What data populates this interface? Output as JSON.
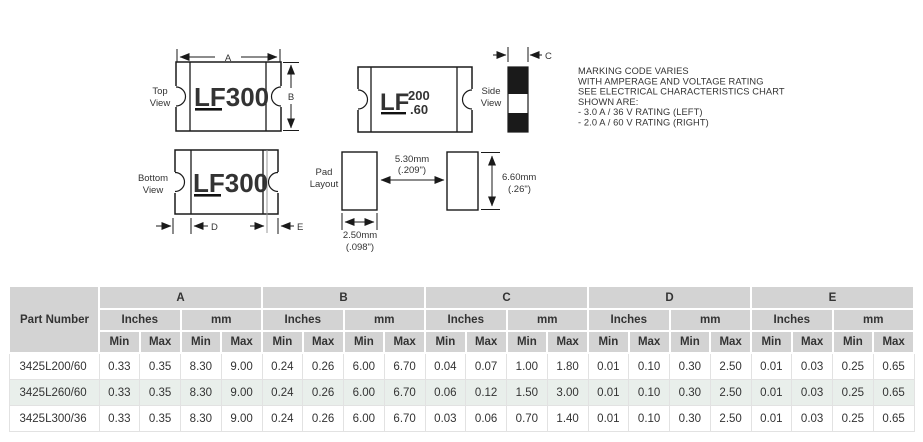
{
  "colors": {
    "table_header_bg": "#d3d3d3",
    "table_row_alt": "#e9efeb",
    "line": "#1a1a1a"
  },
  "diagram": {
    "top_view": {
      "label1": "Top",
      "label2": "View",
      "marking_logo": "LF",
      "marking_text": "300"
    },
    "right_unit": {
      "marking_logo": "LF",
      "marking_top": "200",
      "marking_bottom": ".60"
    },
    "side_view": {
      "label1": "Side",
      "label2": "View"
    },
    "bottom_view": {
      "label1": "Bottom",
      "label2": "View",
      "marking_logo": "LF",
      "marking_text": "300"
    },
    "pad_layout": {
      "label1": "Pad",
      "label2": "Layout",
      "gap_mm": "5.30mm",
      "gap_in": "(.209\")",
      "height_mm": "6.60mm",
      "height_in": "(.26\")",
      "width_mm": "2.50mm",
      "width_in": "(.098\")"
    },
    "dims": {
      "a": "A",
      "b": "B",
      "c": "C",
      "d": "D",
      "e": "E"
    },
    "note": {
      "lines": [
        "MARKING CODE VARIES",
        "WITH AMPERAGE AND VOLTAGE RATING",
        "SEE ELECTRICAL CHARACTERISTICS CHART",
        "SHOWN ARE:",
        "- 3.0 A / 36 V RATING (LEFT)",
        "- 2.0 A / 60 V RATING (RIGHT)"
      ]
    }
  },
  "table": {
    "part_number_header": "Part Number",
    "groups": [
      "A",
      "B",
      "C",
      "D",
      "E"
    ],
    "units": [
      "Inches",
      "mm"
    ],
    "minmax": [
      "Min",
      "Max"
    ],
    "rows": [
      {
        "part": "3425L200/60",
        "values": [
          "0.33",
          "0.35",
          "8.30",
          "9.00",
          "0.24",
          "0.26",
          "6.00",
          "6.70",
          "0.04",
          "0.07",
          "1.00",
          "1.80",
          "0.01",
          "0.10",
          "0.30",
          "2.50",
          "0.01",
          "0.03",
          "0.25",
          "0.65"
        ]
      },
      {
        "part": "3425L260/60",
        "values": [
          "0.33",
          "0.35",
          "8.30",
          "9.00",
          "0.24",
          "0.26",
          "6.00",
          "6.70",
          "0.06",
          "0.12",
          "1.50",
          "3.00",
          "0.01",
          "0.10",
          "0.30",
          "2.50",
          "0.01",
          "0.03",
          "0.25",
          "0.65"
        ]
      },
      {
        "part": "3425L300/36",
        "values": [
          "0.33",
          "0.35",
          "8.30",
          "9.00",
          "0.24",
          "0.26",
          "6.00",
          "6.70",
          "0.03",
          "0.06",
          "0.70",
          "1.40",
          "0.01",
          "0.10",
          "0.30",
          "2.50",
          "0.01",
          "0.03",
          "0.25",
          "0.65"
        ]
      }
    ]
  }
}
